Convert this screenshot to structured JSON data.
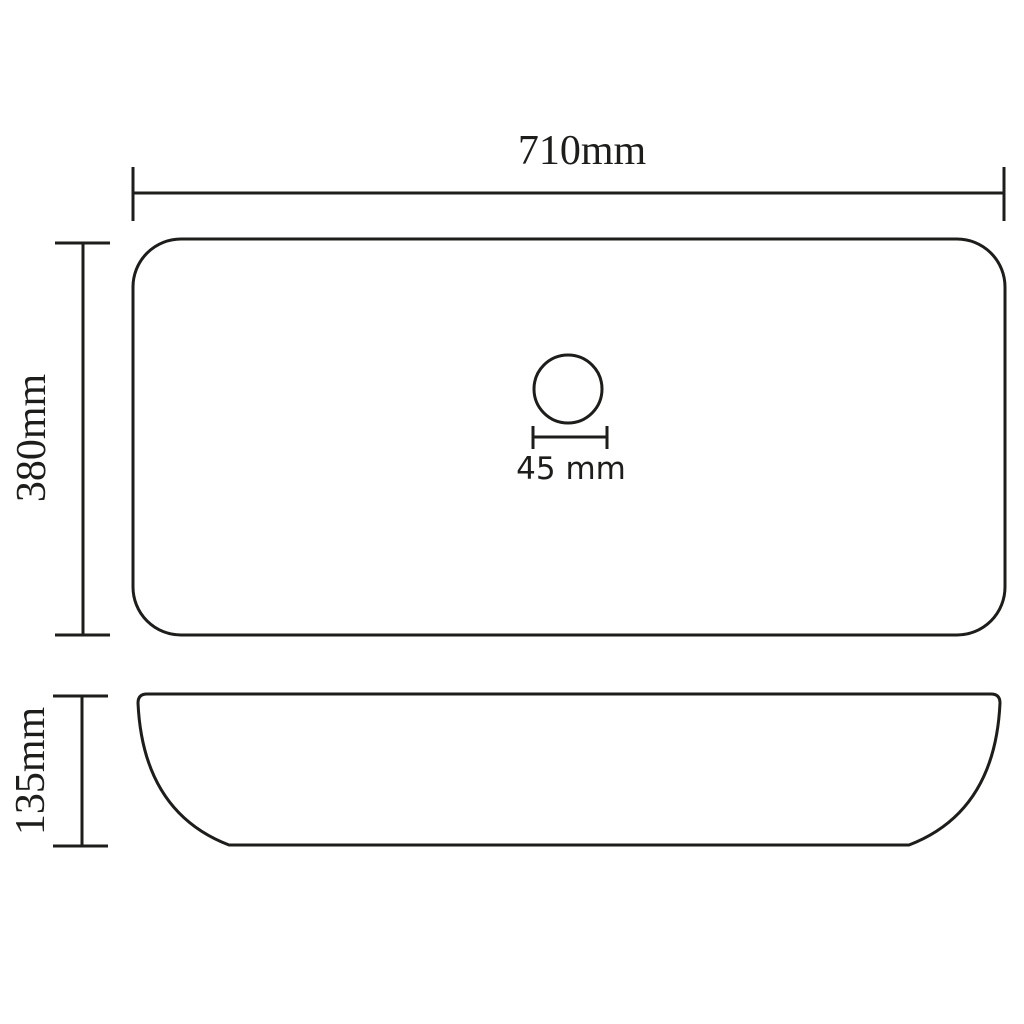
{
  "canvas": {
    "background": "#ffffff",
    "line_color": "#1d1d1b"
  },
  "drawing": {
    "views": [
      "top-view",
      "side-view"
    ],
    "dimension_labels": {
      "width": "710mm",
      "depth": "380mm",
      "drain_diameter": "45 mm",
      "height": "135mm"
    }
  }
}
